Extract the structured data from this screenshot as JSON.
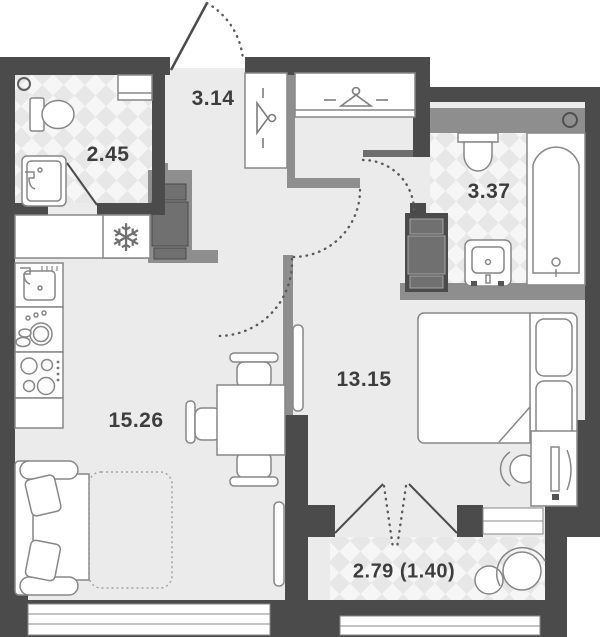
{
  "title": "Apartment floor plan",
  "rooms": [
    {
      "name": "hallway",
      "area": "3.14"
    },
    {
      "name": "wc",
      "area": "2.45"
    },
    {
      "name": "bathroom",
      "area": "3.37"
    },
    {
      "name": "bedroom",
      "area": "13.15"
    },
    {
      "name": "living-kitchen",
      "area": "15.26"
    },
    {
      "name": "balcony",
      "area": "2.79 (1.40)"
    }
  ],
  "icons": {
    "fridge_glyph": "❄",
    "fridge": "snowflake-icon",
    "wardrobe": "hanger-icon",
    "ventilation": "circle-icon"
  },
  "colors": {
    "outer_wall": "#4b4b4b",
    "inner_wall": "#8e8e8e",
    "floor": "#ebebeb",
    "tile_light": "#f6f6f6",
    "tile_dark": "#e7e7e7",
    "furniture_outline": "#878787"
  }
}
